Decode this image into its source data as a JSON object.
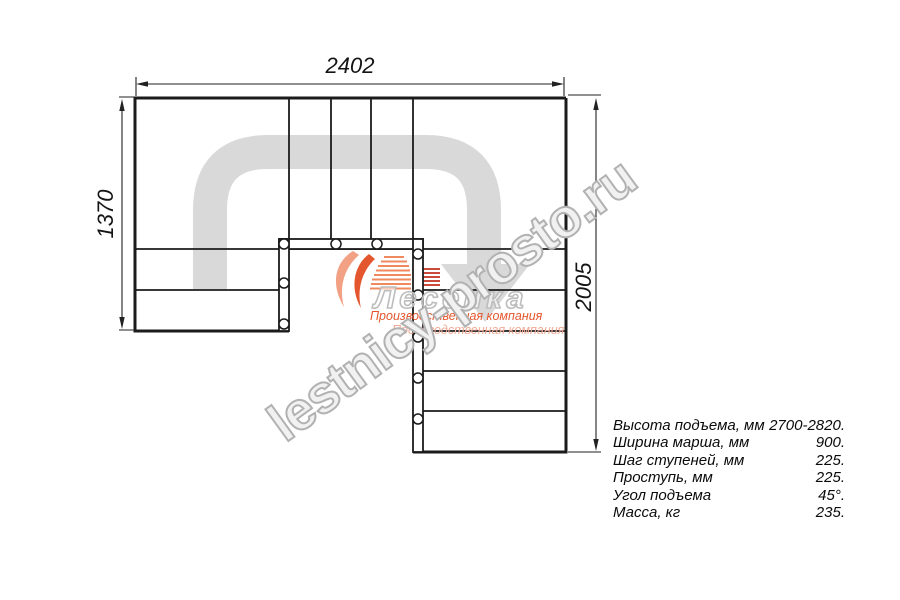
{
  "dimensions": {
    "top": "2402",
    "left": "1370",
    "right": "2005"
  },
  "watermark": {
    "site": "lestnicy-prosto.ru",
    "logo_name": "Лесенка",
    "logo_caption_1": "Производственная компания",
    "logo_caption_2": "Производственная компания"
  },
  "specs": {
    "rows": [
      {
        "label": "Высота подъема, мм",
        "value": "2700-2820."
      },
      {
        "label": "Ширина марша, мм",
        "value": "900."
      },
      {
        "label": "Шаг ступеней, мм",
        "value": "225."
      },
      {
        "label": "Проступь, мм",
        "value": "225."
      },
      {
        "label": "Угол подъема",
        "value": "45°."
      },
      {
        "label": "Масса, кг",
        "value": "235."
      }
    ]
  },
  "colors": {
    "line": "#1b1b1b",
    "arrow_gray": "#d9d9d9",
    "logo_orange": "#e4572e",
    "watermark_gray": "#b2b2b2"
  }
}
